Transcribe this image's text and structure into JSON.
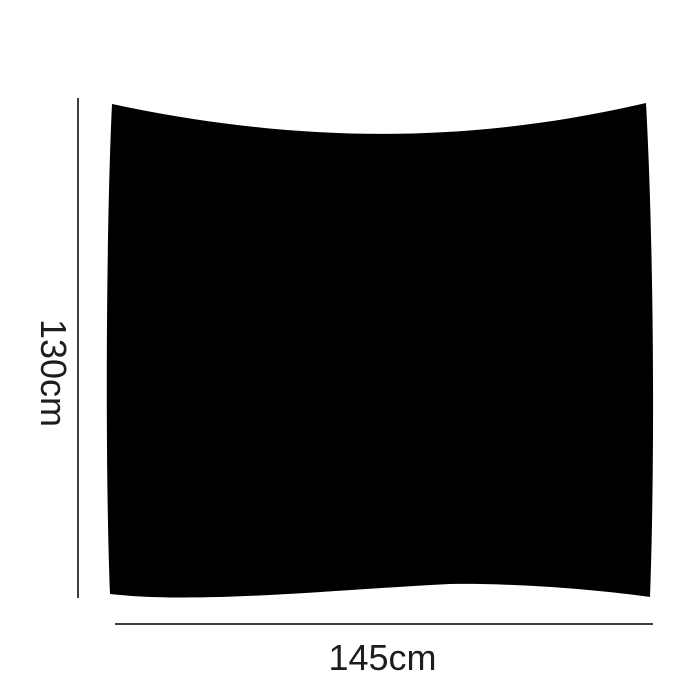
{
  "figure": {
    "height_label": "130cm",
    "width_label": "145cm",
    "colors": {
      "shape": "#000000",
      "dimension_line": "#3e3e3e",
      "label_text": "#1d1d1d",
      "background": "#ffffff"
    }
  }
}
